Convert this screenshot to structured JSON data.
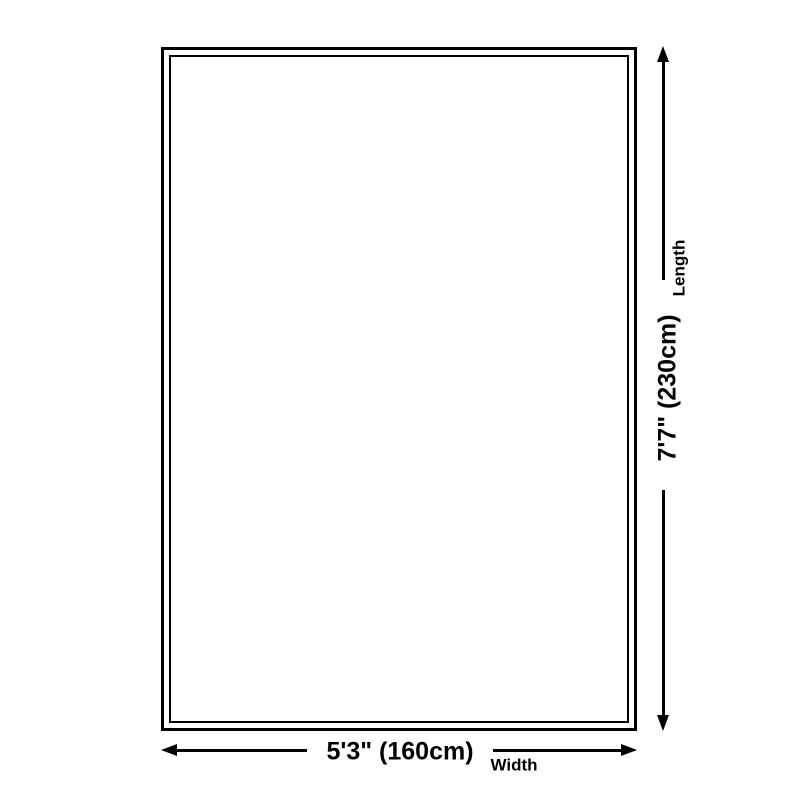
{
  "colors": {
    "line": "#000000",
    "background": "#ffffff"
  },
  "diagram": {
    "type": "product-dimension-diagram",
    "length": {
      "value": "7'7\" (230cm)",
      "label": "Length"
    },
    "width": {
      "value": "5'3\" (160cm)",
      "label": "Width"
    }
  }
}
